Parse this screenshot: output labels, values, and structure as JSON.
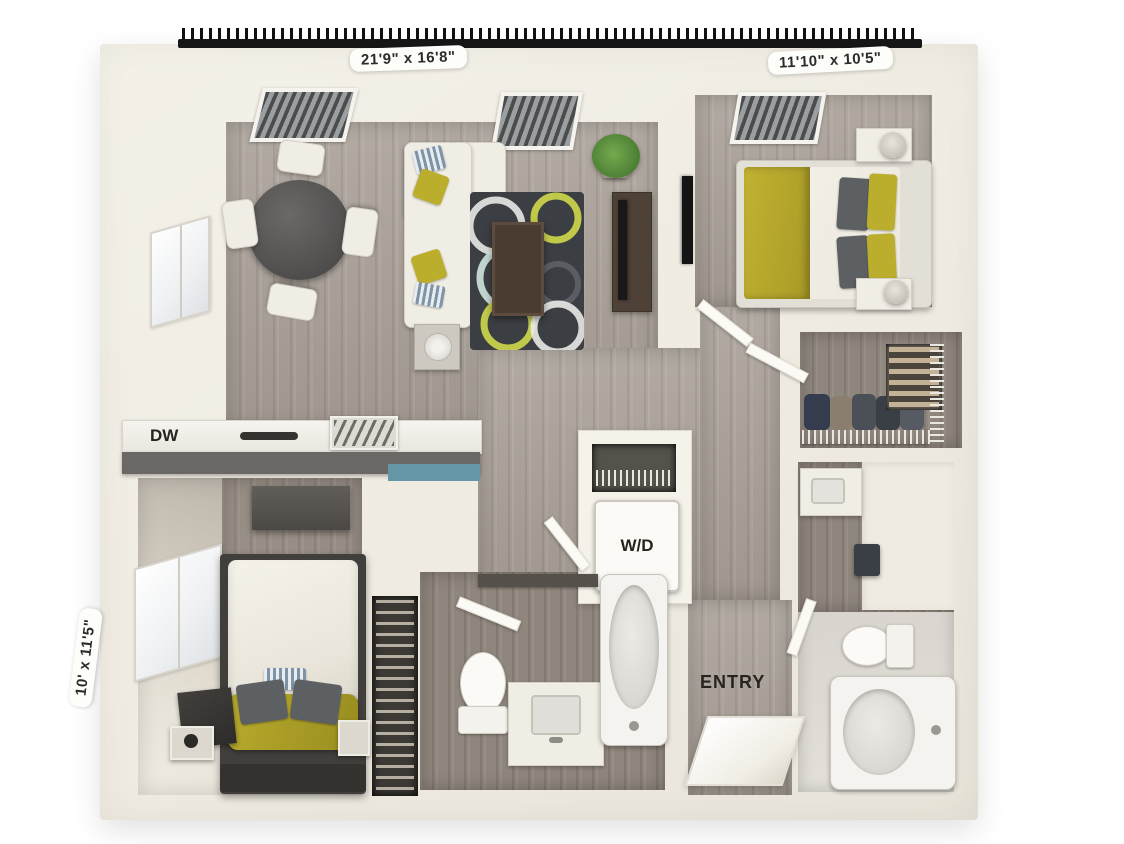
{
  "floorplan": {
    "labels": {
      "living_room_dim": "21'9\" x 16'8\"",
      "bedroom1_dim": "11'10\" x 10'5\"",
      "bedroom2_dim": "10' x 11'5\"",
      "dishwasher": "DW",
      "washer_dryer": "W/D",
      "entry": "ENTRY"
    },
    "rooms": [
      {
        "name": "living-dining-room",
        "dimension": "21'9\" x 16'8\""
      },
      {
        "name": "bedroom-1",
        "dimension": "11'10\" x 10'5\""
      },
      {
        "name": "bedroom-2",
        "dimension": "10' x 11'5\""
      },
      {
        "name": "kitchen"
      },
      {
        "name": "walk-in-closet"
      },
      {
        "name": "bathroom-1"
      },
      {
        "name": "bathroom-2"
      },
      {
        "name": "laundry-closet"
      },
      {
        "name": "entry-hall"
      }
    ],
    "colors": {
      "wall": "#f0ece2",
      "floor_wood": "#a89f96",
      "floor_wood_dark": "#8f867d",
      "carpet": "#e8e3d8",
      "rug": "#3b3e42",
      "accent_yellow": "#bcae2d",
      "accent_teal": "#6496a6",
      "counter_gray": "#6a6765",
      "railing": "#161616",
      "furniture_white": "#f0ede5"
    }
  }
}
